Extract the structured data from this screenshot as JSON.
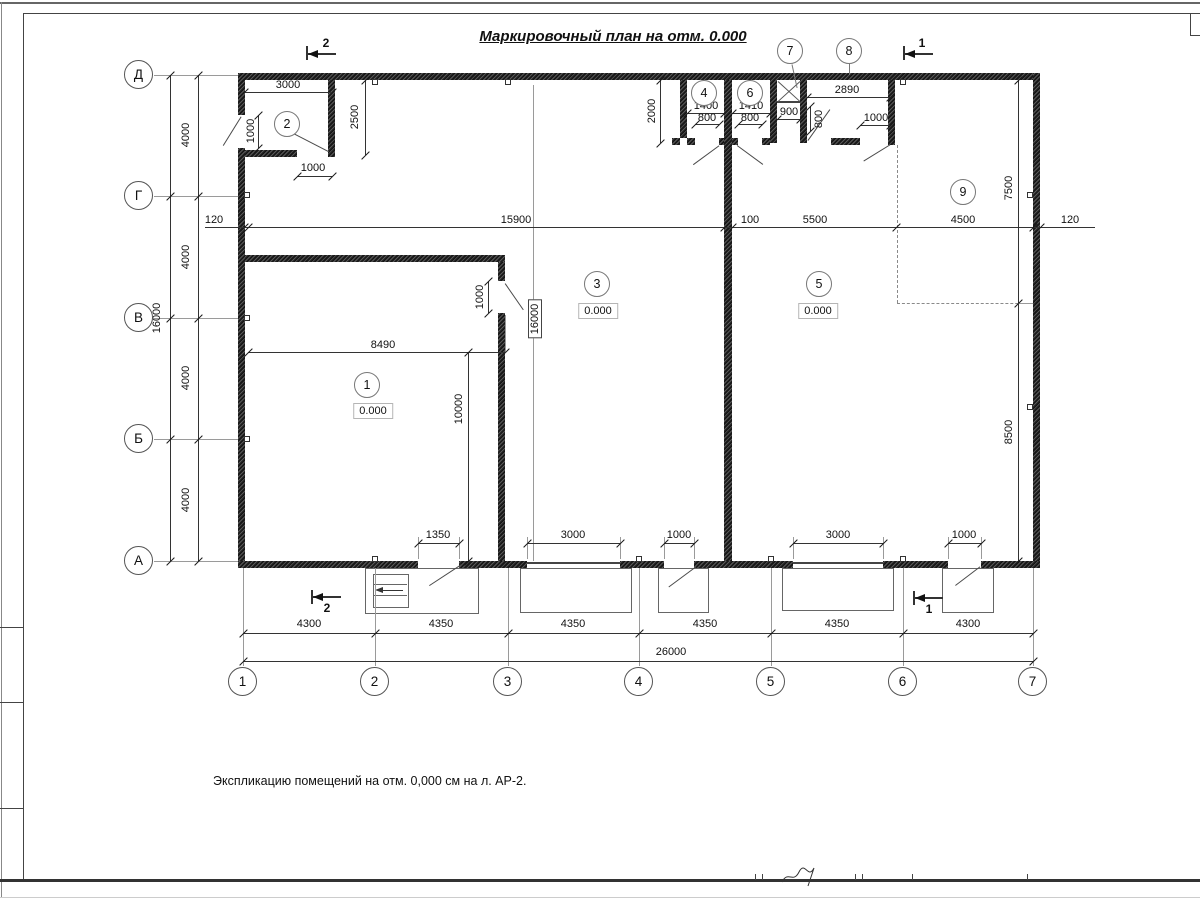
{
  "title": "Маркировочный план на отм. 0.000",
  "note": "Экспликацию помещений на отм. 0,000 см на л. АР-2.",
  "axes": {
    "rows": [
      "Д",
      "Г",
      "В",
      "Б",
      "А"
    ],
    "cols": [
      "1",
      "2",
      "3",
      "4",
      "5",
      "6",
      "7"
    ]
  },
  "section_marks": {
    "cut_2": "2",
    "cut_1": "1"
  },
  "rooms": {
    "r1": {
      "number": "1",
      "elevation": "0.000"
    },
    "r2": {
      "number": "2"
    },
    "r3": {
      "number": "3",
      "elevation": "0.000"
    },
    "r4": {
      "number": "4"
    },
    "r5": {
      "number": "5",
      "elevation": "0.000"
    },
    "r6": {
      "number": "6"
    },
    "r7": {
      "number": "7"
    },
    "r8": {
      "number": "8"
    },
    "r9": {
      "number": "9"
    }
  },
  "dimensions": {
    "overall_width": "26000",
    "overall_height": "16000",
    "bay_4300": "4300",
    "bay_4350": "4350",
    "axis_step_4000": "4000",
    "offset_120": "120",
    "span_15900": "15900",
    "wall_100": "100",
    "span_5500": "5500",
    "span_4500": "4500",
    "room2_width_3000": "3000",
    "room2_depth_2500": "2500",
    "door_1000": "1000",
    "top_depth_2000": "2000",
    "room4_width_1400": "1400",
    "door_800": "800",
    "room6_width_1410": "1410",
    "shaft_900": "900",
    "span_2890": "2890",
    "right_depth_7500": "7500",
    "right_depth_8500": "8500",
    "room1_width_8490": "8490",
    "room1_depth_10000": "10000",
    "hall_16000": "16000",
    "door_1350": "1350",
    "door_3000": "3000"
  }
}
